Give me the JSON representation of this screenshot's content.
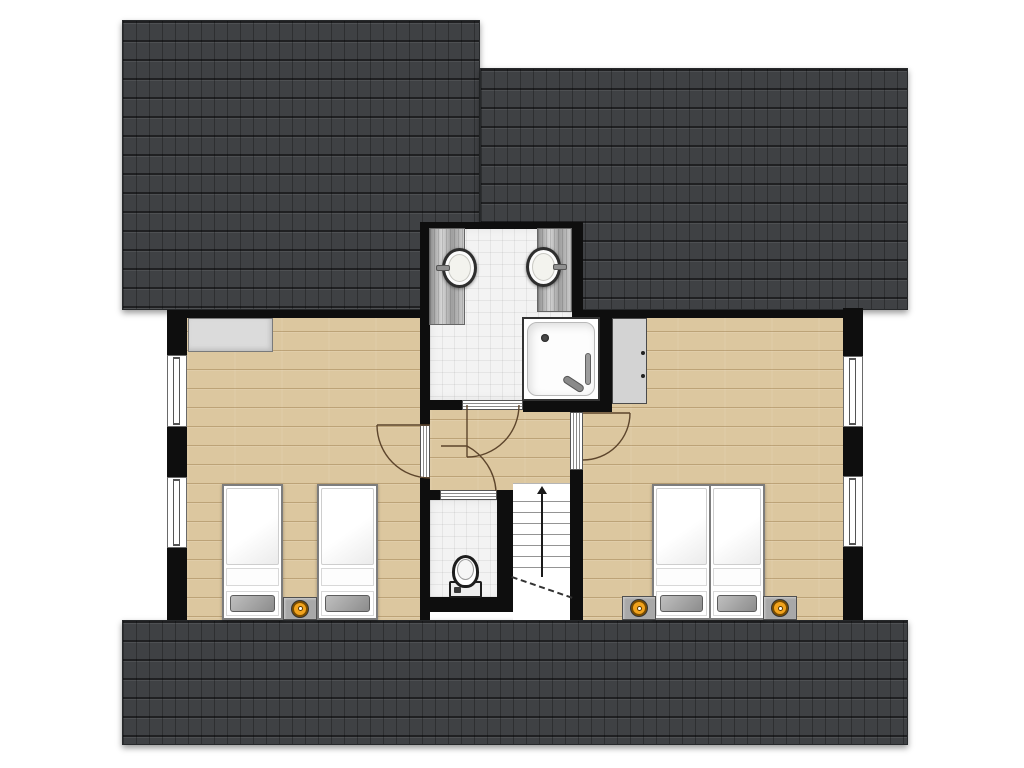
{
  "canvas": {
    "width": 1024,
    "height": 768,
    "background": "#ffffff"
  },
  "palette": {
    "roof": "#3f4144",
    "wall": "#0e0e0e",
    "wood": "#dcc79f",
    "tile": "#f3f3f3",
    "knob": "#f2a31d",
    "arc": "#5d452c"
  },
  "floorplan": {
    "elements": [
      {
        "name": "roof-top-left",
        "type": "roof",
        "x": 122,
        "y": 20,
        "w": 358,
        "h": 290
      },
      {
        "name": "roof-top-right",
        "type": "roof",
        "x": 480,
        "y": 68,
        "w": 428,
        "h": 242
      },
      {
        "name": "roof-bottom",
        "type": "roof",
        "x": 122,
        "y": 620,
        "w": 786,
        "h": 125
      },
      {
        "name": "bedroom-left-floor",
        "type": "wood",
        "x": 187,
        "y": 312,
        "w": 243,
        "h": 308
      },
      {
        "name": "bedroom-right-floor",
        "type": "wood",
        "x": 583,
        "y": 312,
        "w": 260,
        "h": 308
      },
      {
        "name": "hallway-floor",
        "type": "wood",
        "x": 430,
        "y": 400,
        "w": 140,
        "h": 90
      },
      {
        "name": "bathroom-floor",
        "type": "tile",
        "x": 430,
        "y": 228,
        "w": 142,
        "h": 172
      },
      {
        "name": "wc-floor",
        "type": "tile",
        "x": 430,
        "y": 500,
        "w": 70,
        "h": 100
      },
      {
        "name": "top-wall-left",
        "type": "wall",
        "x": 167,
        "y": 310,
        "w": 263,
        "h": 8
      },
      {
        "name": "top-wall-right",
        "type": "wall",
        "x": 572,
        "y": 310,
        "w": 291,
        "h": 8
      },
      {
        "name": "left-wall-upper",
        "type": "wall",
        "x": 167,
        "y": 310,
        "w": 20,
        "h": 45
      },
      {
        "name": "left-wall-mid",
        "type": "wall",
        "x": 167,
        "y": 427,
        "w": 20,
        "h": 50
      },
      {
        "name": "left-wall-lower",
        "type": "wall",
        "x": 167,
        "y": 548,
        "w": 20,
        "h": 72
      },
      {
        "name": "right-wall-upper",
        "type": "wall",
        "x": 843,
        "y": 308,
        "w": 20,
        "h": 48
      },
      {
        "name": "right-wall-mid",
        "type": "wall",
        "x": 843,
        "y": 427,
        "w": 20,
        "h": 49
      },
      {
        "name": "right-wall-lower",
        "type": "wall",
        "x": 843,
        "y": 547,
        "w": 20,
        "h": 73
      },
      {
        "name": "bathroom-north-wall",
        "type": "wall",
        "x": 420,
        "y": 222,
        "w": 163,
        "h": 7
      },
      {
        "name": "bathroom-west-wall",
        "type": "wall",
        "x": 420,
        "y": 222,
        "w": 10,
        "h": 203
      },
      {
        "name": "bathroom-east-wall",
        "type": "wall",
        "x": 572,
        "y": 222,
        "w": 11,
        "h": 96
      },
      {
        "name": "bathroom-south-wall-west",
        "type": "wall",
        "x": 420,
        "y": 400,
        "w": 42,
        "h": 10
      },
      {
        "name": "bathroom-south-wall-east",
        "type": "wall",
        "x": 523,
        "y": 400,
        "w": 89,
        "h": 12
      },
      {
        "name": "shower-east-wall",
        "type": "wall",
        "x": 600,
        "y": 313,
        "w": 12,
        "h": 99
      },
      {
        "name": "bedroom-left-east-wall",
        "type": "wall",
        "x": 420,
        "y": 478,
        "w": 10,
        "h": 142
      },
      {
        "name": "bedroom-right-west-wall-upper",
        "type": "wall",
        "x": 570,
        "y": 400,
        "w": 13,
        "h": 12
      },
      {
        "name": "bedroom-right-west-wall-lower",
        "type": "wall",
        "x": 570,
        "y": 470,
        "w": 13,
        "h": 150
      },
      {
        "name": "wc-north-wall",
        "type": "wall",
        "x": 430,
        "y": 490,
        "w": 10,
        "h": 10
      },
      {
        "name": "wc-east-wall",
        "type": "wall",
        "x": 497,
        "y": 490,
        "w": 16,
        "h": 112
      },
      {
        "name": "wc-south-wall",
        "type": "wall",
        "x": 420,
        "y": 597,
        "w": 93,
        "h": 15
      },
      {
        "name": "window-left-1",
        "type": "window",
        "x": 167,
        "y": 355,
        "w": 20,
        "h": 72
      },
      {
        "name": "window-left-2",
        "type": "window",
        "x": 167,
        "y": 477,
        "w": 20,
        "h": 71
      },
      {
        "name": "window-right-1",
        "type": "window",
        "x": 843,
        "y": 356,
        "w": 20,
        "h": 71
      },
      {
        "name": "window-right-2",
        "type": "window",
        "x": 843,
        "y": 476,
        "w": 20,
        "h": 71
      },
      {
        "name": "door-frame-bedroom-left",
        "type": "thr-v",
        "x": 420,
        "y": 425,
        "w": 10,
        "h": 53
      },
      {
        "name": "door-frame-bedroom-right",
        "type": "thr-v",
        "x": 570,
        "y": 412,
        "w": 13,
        "h": 58
      },
      {
        "name": "door-frame-bathroom",
        "type": "thr-h",
        "x": 462,
        "y": 400,
        "w": 61,
        "h": 10
      },
      {
        "name": "door-frame-wc",
        "type": "thr-h",
        "x": 440,
        "y": 490,
        "w": 57,
        "h": 10
      },
      {
        "name": "sideboard",
        "type": "counter",
        "x": 188,
        "y": 318,
        "w": 85,
        "h": 34
      },
      {
        "name": "vanity-left",
        "type": "vanity",
        "x": 429,
        "y": 228,
        "w": 36,
        "h": 97
      },
      {
        "name": "vanity-right",
        "type": "vanity",
        "x": 537,
        "y": 228,
        "w": 35,
        "h": 84
      },
      {
        "name": "sink-left",
        "type": "sink",
        "x": 442,
        "y": 248,
        "w": 35,
        "h": 40,
        "side": "left"
      },
      {
        "name": "sink-right",
        "type": "sink",
        "x": 526,
        "y": 247,
        "w": 35,
        "h": 40,
        "side": "right"
      },
      {
        "name": "shower",
        "type": "shower",
        "x": 522,
        "y": 317,
        "w": 78,
        "h": 84
      },
      {
        "name": "wardrobe",
        "type": "wardrobe",
        "x": 612,
        "y": 318,
        "w": 35,
        "h": 86
      },
      {
        "name": "toilet",
        "type": "toilet",
        "x": 449,
        "y": 555,
        "w": 33,
        "h": 43
      },
      {
        "name": "staircase",
        "type": "stairs",
        "x": 513,
        "y": 483,
        "w": 57,
        "h": 137
      },
      {
        "name": "bed-single-1",
        "type": "bed",
        "x": 222,
        "y": 484,
        "w": 61,
        "h": 136,
        "beds": 1
      },
      {
        "name": "bed-single-2",
        "type": "bed",
        "x": 317,
        "y": 484,
        "w": 61,
        "h": 136,
        "beds": 1
      },
      {
        "name": "bed-double",
        "type": "bed",
        "x": 652,
        "y": 484,
        "w": 113,
        "h": 136,
        "beds": 2
      },
      {
        "name": "nightstand-left",
        "type": "nightstand",
        "x": 283,
        "y": 597,
        "w": 34,
        "h": 23
      },
      {
        "name": "nightstand-right-1",
        "type": "nightstand",
        "x": 622,
        "y": 596,
        "w": 34,
        "h": 24
      },
      {
        "name": "nightstand-right-2",
        "type": "nightstand",
        "x": 763,
        "y": 596,
        "w": 34,
        "h": 24
      }
    ],
    "door_swings": [
      {
        "name": "door-swing-bedroom-left",
        "d": "M430 425 L377 425 M377 425 A53 53 0 0 0 430 478"
      },
      {
        "name": "door-swing-bedroom-right",
        "d": "M583 413 L630 413 M630 413 A47 47 0 0 1 583 460"
      },
      {
        "name": "door-swing-bathroom",
        "d": "M467 405 L467 457 M467 457 A52 52 0 0 0 519 405"
      },
      {
        "name": "door-swing-wc",
        "d": "M441 446 L467 446 M467 446 A55 55 0 0 1 496 491"
      }
    ]
  }
}
